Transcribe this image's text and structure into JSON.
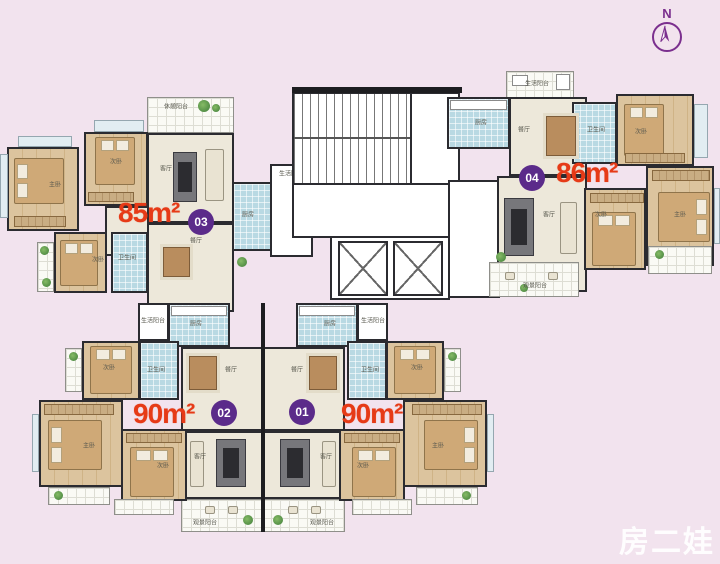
{
  "colors": {
    "background": "#f2e3ee",
    "area_label": "#e63a17",
    "badge": "#5b2b8a",
    "north_arrow": "#7b2f8e",
    "wall": "#2b2b30"
  },
  "north": {
    "label": "N"
  },
  "watermark": {
    "text": "房二娃"
  },
  "units": {
    "u01": {
      "badge": "01",
      "area": "90m²",
      "rooms": {
        "kitchen": "厨房",
        "dining": "餐厅",
        "living": "客厅",
        "bath": "卫生间",
        "bed_a": "次卧",
        "bed_b": "次卧",
        "master": "主卧",
        "view_balcony": "观景阳台",
        "service_balcony": "生活阳台"
      }
    },
    "u02": {
      "badge": "02",
      "area": "90m²",
      "rooms": {
        "kitchen": "厨房",
        "dining": "餐厅",
        "living": "客厅",
        "bath": "卫生间",
        "bed_a": "次卧",
        "bed_b": "次卧",
        "master": "主卧",
        "view_balcony": "观景阳台",
        "service_balcony": "生活阳台"
      }
    },
    "u03": {
      "badge": "03",
      "area": "85m²",
      "rooms": {
        "rest_balcony": "休憩阳台",
        "living": "客厅",
        "dining": "餐厅",
        "bed_a": "次卧",
        "bed_b": "次卧",
        "master": "主卧",
        "bath": "卫生间",
        "kitchen": "厨房",
        "service_balcony": "生活阳台"
      }
    },
    "u04": {
      "badge": "04",
      "area": "86m²",
      "rooms": {
        "service_balcony": "生活阳台",
        "kitchen": "厨房",
        "dining": "餐厅",
        "bath": "卫生间",
        "bed_a": "次卧",
        "bed_b": "次卧",
        "master": "主卧",
        "living": "客厅",
        "view_balcony": "观景阳台"
      }
    }
  }
}
